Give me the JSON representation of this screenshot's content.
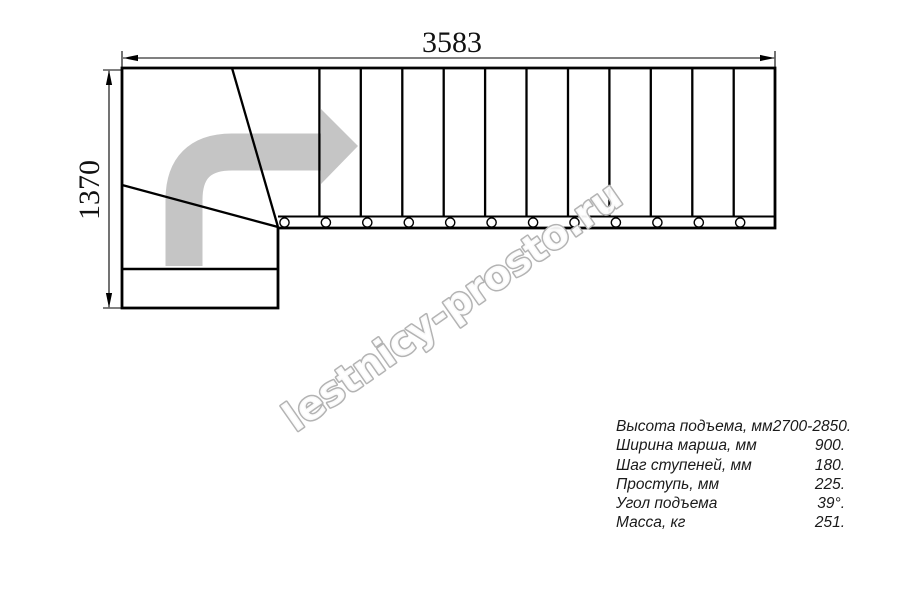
{
  "drawing": {
    "dimensions": {
      "width_label": "3583",
      "height_label": "1370"
    },
    "watermark_text": "lestnicy-prosto.ru",
    "colors": {
      "line": "#000000",
      "arrow_fill": "#c5c5c5",
      "watermark_stroke": "#b3b3b3",
      "watermark_fill": "#ffffff"
    }
  },
  "specs": {
    "rows": [
      {
        "label": "Высота подъема, мм",
        "value": "2700-2850."
      },
      {
        "label": "Ширина марша, мм",
        "value": "900."
      },
      {
        "label": "Шаг ступеней, мм",
        "value": "180."
      },
      {
        "label": "Проступь, мм",
        "value": "225."
      },
      {
        "label": "Угол подъема",
        "value": "39°."
      },
      {
        "label": "Масса, кг",
        "value": "251."
      }
    ]
  }
}
